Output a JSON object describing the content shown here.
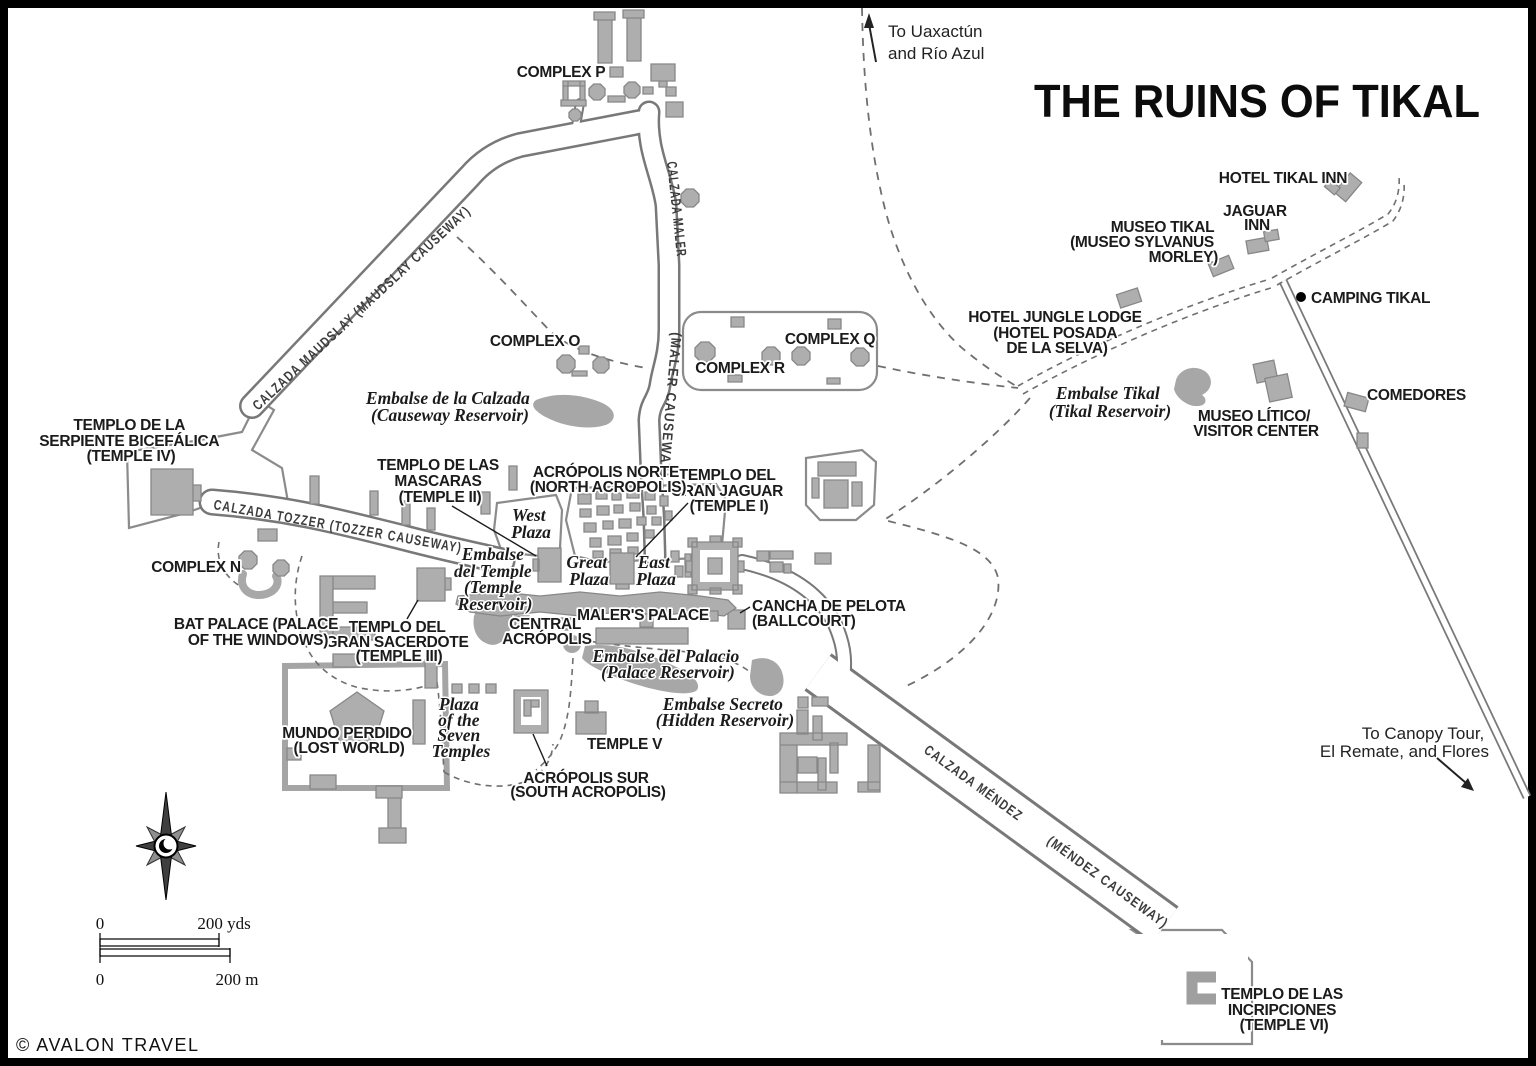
{
  "title": "THE RUINS OF TIKAL",
  "copyright": "© AVALON TRAVEL",
  "directions": {
    "uaxactun": [
      "To Uaxactún",
      "and Río Azul"
    ],
    "canopy": [
      "To Canopy Tour,",
      "El Remate, and Flores"
    ]
  },
  "causeways": {
    "maudslay": "CALZADA MAUDSLAY (MAUDSLAY CAUSEWAY)",
    "maler_name": "CALZADA MALER",
    "maler_paren": "(MALER CAUSEWAY)",
    "tozzer": "CALZADA TOZZER (TOZZER CAUSEWAY)",
    "mendez_name": "CALZADA MÉNDEZ",
    "mendez_paren": "(MÉNDEZ CAUSEWAY)"
  },
  "complexes": {
    "p": "COMPLEX P",
    "o": "COMPLEX O",
    "q": "COMPLEX Q",
    "r": "COMPLEX R",
    "n": "COMPLEX N"
  },
  "temples": {
    "temple4": [
      "TEMPLO DE LA",
      "SERPIENTE BICEFÁLICA",
      "(TEMPLE IV)"
    ],
    "temple2": [
      "TEMPLO DE LAS",
      "MASCARAS",
      "(TEMPLE II)"
    ],
    "temple1": [
      "TEMPLO DEL",
      "GRAN JAGUAR",
      "(TEMPLE I)"
    ],
    "temple3": [
      "TEMPLO DEL",
      "GRAN SACERDOTE",
      "(TEMPLE III)"
    ],
    "temple5": "TEMPLE V",
    "temple6": [
      "TEMPLO DE LAS",
      "INCRIPCIONES",
      "(TEMPLE VI)"
    ]
  },
  "acropolis": {
    "north": [
      "ACRÓPOLIS NORTE",
      "(NORTH ACROPOLIS)"
    ],
    "central": [
      "CENTRAL",
      "ACRÓPOLIS"
    ],
    "south": [
      "ACRÓPOLIS SUR",
      "(SOUTH ACROPOLIS)"
    ]
  },
  "sites": {
    "maler_palace": "MALER'S PALACE",
    "ballcourt": [
      "CANCHA DE PELOTA",
      "(BALLCOURT)"
    ],
    "bat_palace": [
      "BAT PALACE (PALACE",
      "OF THE WINDOWS)"
    ],
    "mundo_perdido": [
      "MUNDO PERDIDO",
      "(LOST WORLD)"
    ]
  },
  "plazas": {
    "west": [
      "West",
      "Plaza"
    ],
    "great": [
      "Great",
      "Plaza"
    ],
    "east": [
      "East",
      "Plaza"
    ],
    "seven": [
      "Plaza",
      "of the",
      "Seven",
      "Temples"
    ]
  },
  "reservoirs": {
    "causeway": [
      "Embalse de la Calzada",
      "(Causeway Reservoir)"
    ],
    "tikal": [
      "Embalse Tikal",
      "(Tikal Reservoir)"
    ],
    "temple": [
      "Embalse",
      "del Temple",
      "(Temple",
      "Reservoir)"
    ],
    "palace": [
      "Embalse del Palacio",
      "(Palace Reservoir)"
    ],
    "hidden": [
      "Embalse Secreto",
      "(Hidden Reservoir)"
    ]
  },
  "facilities": {
    "hotel_tikal_inn": "HOTEL TIKAL INN",
    "jaguar_inn": [
      "JAGUAR",
      "INN"
    ],
    "museo_tikal": [
      "MUSEO TIKAL",
      "(MUSEO SYLVANUS",
      "MORLEY)"
    ],
    "jungle_lodge": [
      "HOTEL JUNGLE LODGE",
      "(HOTEL POSADA",
      "DE LA SELVA)"
    ],
    "camping": "CAMPING TIKAL",
    "museo_litico": [
      "MUSEO LÍTICO/",
      "VISITOR CENTER"
    ],
    "comedores": "COMEDORES"
  },
  "scale": {
    "yds_zero": "0",
    "yds_max": "200 yds",
    "m_zero": "0",
    "m_max": "200 m"
  },
  "colors": {
    "building": "#aeaeae",
    "road_casing": "#787878",
    "water": "#a7a7a7",
    "text": "#1b1b1b"
  }
}
